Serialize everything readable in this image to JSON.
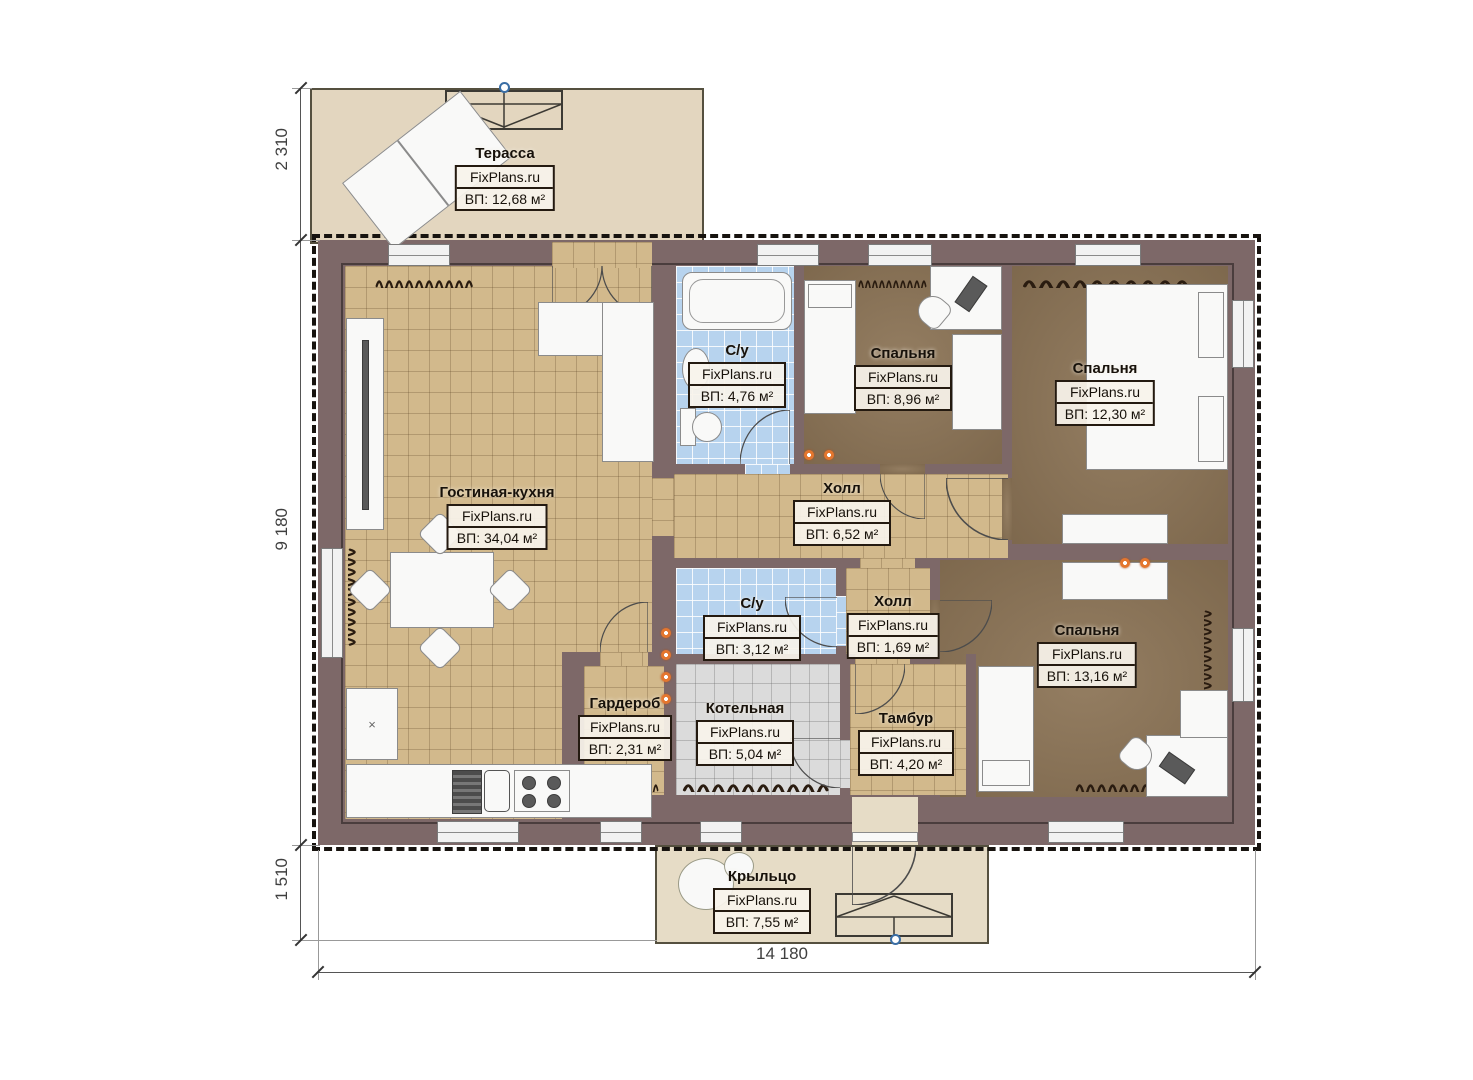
{
  "brand": "FixPlans.ru",
  "plan": {
    "dimensions": {
      "terrace_depth": "2 310",
      "house_depth": "9 180",
      "porch_depth": "1 510",
      "house_width": "14 180"
    },
    "rooms": {
      "terrace": {
        "name": "Терасса",
        "area": "ВП: 12,68 м²"
      },
      "living": {
        "name": "Гостиная-кухня",
        "area": "ВП: 34,04 м²"
      },
      "bath1": {
        "name": "С/у",
        "area": "ВП: 4,76 м²"
      },
      "bed1": {
        "name": "Спальня",
        "area": "ВП: 8,96 м²"
      },
      "bed2": {
        "name": "Спальня",
        "area": "ВП: 12,30 м²"
      },
      "hall1": {
        "name": "Холл",
        "area": "ВП: 6,52 м²"
      },
      "bath2": {
        "name": "С/у",
        "area": "ВП: 3,12 м²"
      },
      "hall2": {
        "name": "Холл",
        "area": "ВП: 1,69 м²"
      },
      "bed3": {
        "name": "Спальня",
        "area": "ВП: 13,16 м²"
      },
      "wardrobe": {
        "name": "Гардероб",
        "area": "ВП: 2,31 м²"
      },
      "boiler": {
        "name": "Котельная",
        "area": "ВП: 5,04 м²"
      },
      "tambour": {
        "name": "Тамбур",
        "area": "ВП: 4,20 м²"
      },
      "porch": {
        "name": "Крыльцо",
        "area": "ВП: 7,55 м²"
      }
    },
    "colors": {
      "wall": "#7d6868",
      "tile_floor": "#d2b98c",
      "bedroom_floor": "#8c7456",
      "bath_floor": "#b7d3ee",
      "boiler_floor": "#dbdbdb",
      "terrace_floor": "#e3d6bf",
      "lamp": "#e4762e"
    }
  }
}
